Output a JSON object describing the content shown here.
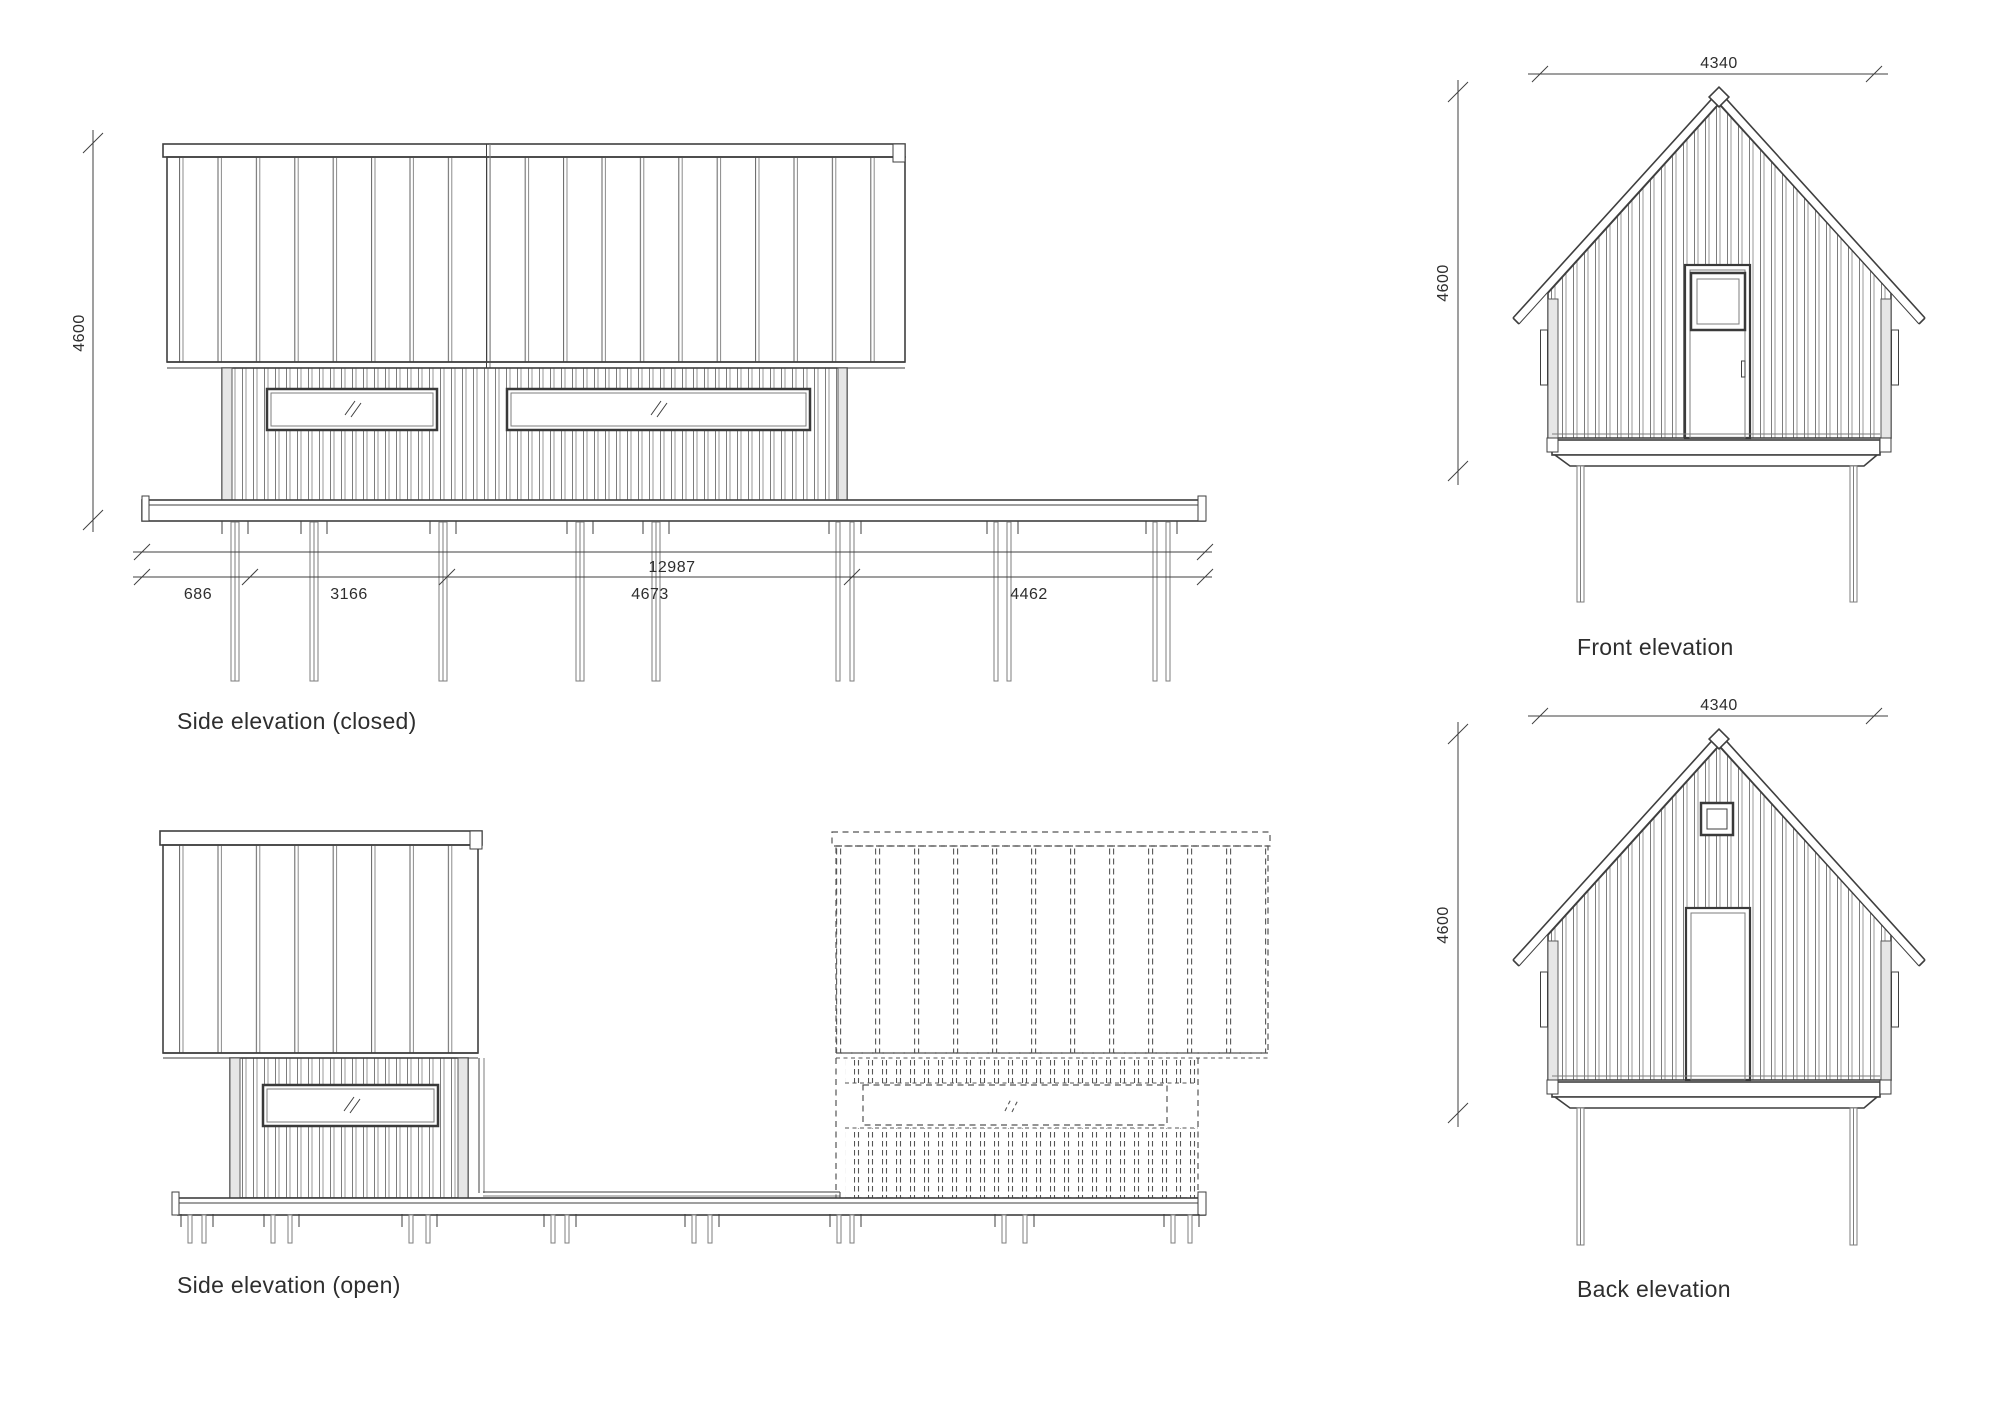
{
  "sheet": {
    "type": "architectural elevations",
    "background": "#ffffff",
    "ink": "#3f3f3f",
    "detail_ink": "#7d7d7d",
    "text_ink": "#2e2e2e"
  },
  "drawings": {
    "side_closed": {
      "label": "Side elevation (closed)",
      "dim_height": "4600",
      "dim_total": "12987",
      "dim_segments": [
        "686",
        "3166",
        "4673",
        "4462"
      ]
    },
    "side_open": {
      "label": "Side elevation (open)"
    },
    "front": {
      "label": "Front elevation",
      "dim_width": "4340",
      "dim_height": "4600"
    },
    "back": {
      "label": "Back elevation",
      "dim_width": "4340",
      "dim_height": "4600"
    }
  }
}
